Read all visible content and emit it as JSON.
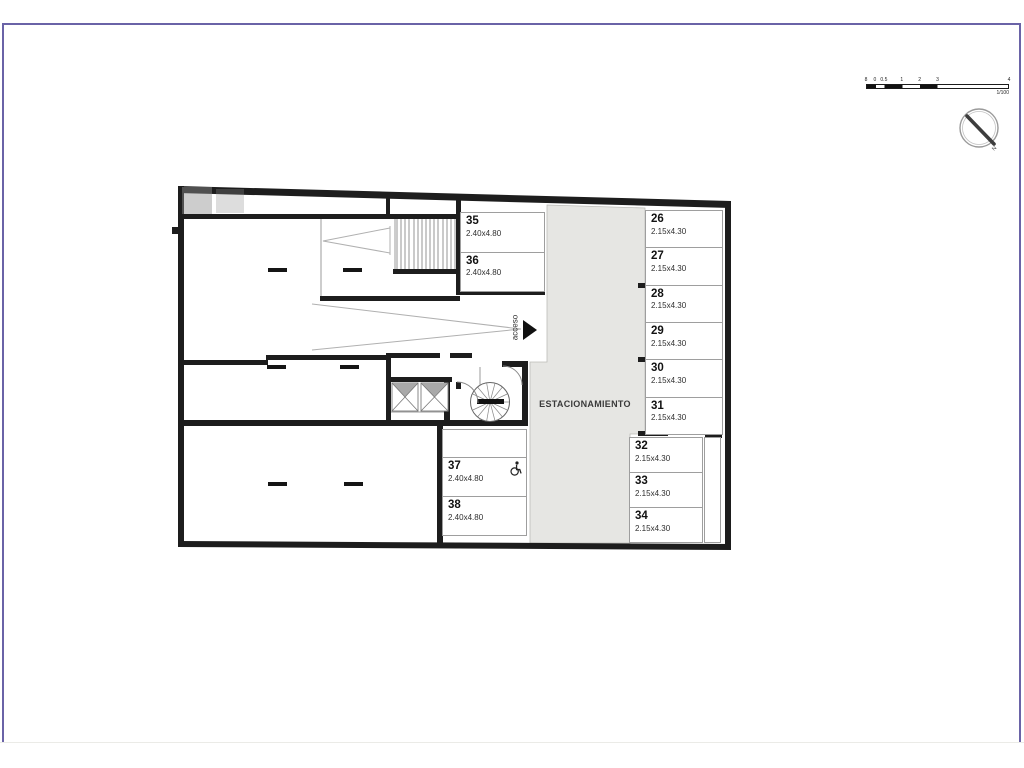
{
  "plan": {
    "area_label": "ESTACIONAMIENTO",
    "access_label": "acceso",
    "spots_left": [
      {
        "number": "35",
        "size": "2.40x4.80"
      },
      {
        "number": "36",
        "size": "2.40x4.80"
      }
    ],
    "spots_center": [
      {
        "number": "37",
        "size": "2.40x4.80",
        "accessible": true
      },
      {
        "number": "38",
        "size": "2.40x4.80"
      }
    ],
    "spots_right_upper": [
      {
        "number": "26",
        "size": "2.15x4.30"
      },
      {
        "number": "27",
        "size": "2.15x4.30"
      },
      {
        "number": "28",
        "size": "2.15x4.30"
      },
      {
        "number": "29",
        "size": "2.15x4.30"
      },
      {
        "number": "30",
        "size": "2.15x4.30"
      },
      {
        "number": "31",
        "size": "2.15x4.30"
      }
    ],
    "spots_right_lower": [
      {
        "number": "32",
        "size": "2.15x4.30"
      },
      {
        "number": "33",
        "size": "2.15x4.30"
      },
      {
        "number": "34",
        "size": "2.15x4.30"
      }
    ]
  },
  "scale_bar": {
    "ticks": [
      "0",
      "0.5",
      "1",
      "2",
      "3",
      "4",
      "8"
    ],
    "ratio": "1/100"
  },
  "compass": {
    "north_label": "N"
  },
  "colors": {
    "wall": "#1d1d1d",
    "driveway": "#e6e6e3",
    "frame": "#6a63a7",
    "thin": "#9e9e9e"
  }
}
